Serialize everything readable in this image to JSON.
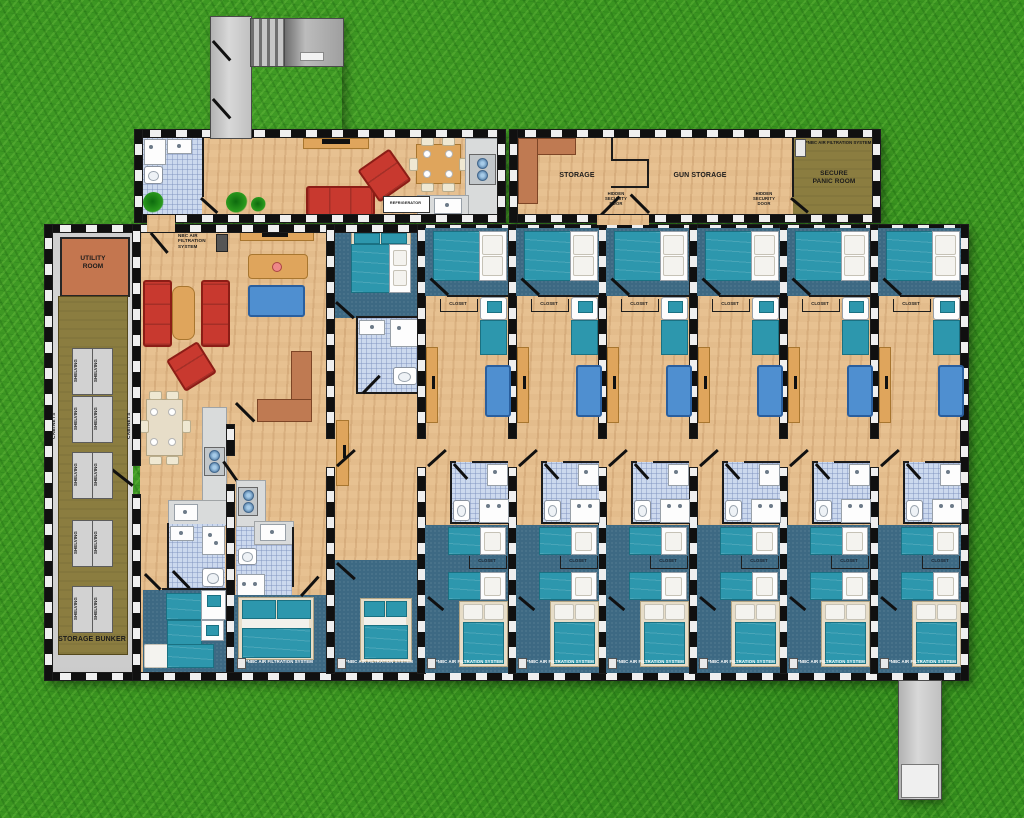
{
  "title": "Underground bunker floor plan",
  "labels": {
    "nbc_inline": "*NBC AIR FILTRATION SYSTEM",
    "nbc_stack": "NBC AIR\nFILTRATION\nSYSTEM",
    "closet": "CLOSET",
    "refrigerator": "REFRIGERATOR",
    "storage": "STORAGE",
    "gun_storage": "GUN STORAGE",
    "secure_panic_room": "SECURE\nPANIC ROOM",
    "hidden_security_door": "HIDDEN\nSECURITY\nDOOR",
    "utility_room": "UTILITY\nROOM",
    "storage_bunker": "STORAGE BUNKER",
    "shelving": "SHELVING",
    "cabinets": "CABINETS"
  },
  "counts": {
    "residential_containers": 6,
    "shelving_units": 10,
    "closet_labels": 12,
    "bottom_nbc_labels": 8,
    "hidden_security_doors": 2
  },
  "colors": {
    "grass": "#3a9420",
    "wood_floor": "#e7c191",
    "carpet": "#3d6983",
    "bathroom_tile": "#ccd9ee",
    "bed_teal": "#2d97ad",
    "sofa_red": "#c8392f",
    "sofa_blue": "#4f8fd0",
    "bunker_olive": "#8b7d40",
    "utility_terracotta": "#c4764f",
    "counter_gray": "#d9dbdb",
    "concrete": "#c9c9c9"
  }
}
